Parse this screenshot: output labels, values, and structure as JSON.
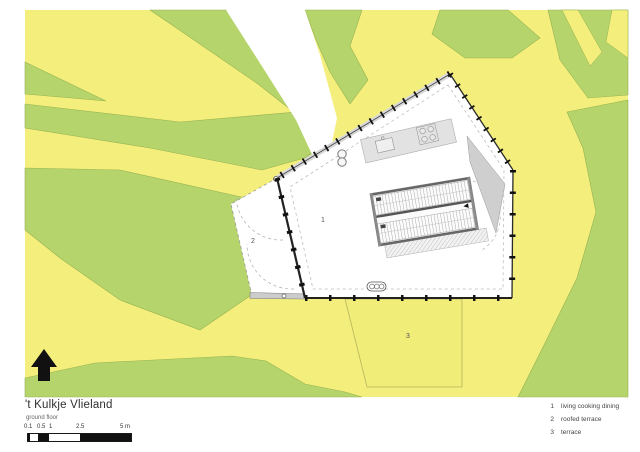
{
  "title": "'t Kulkje Vlieland",
  "subtitle": "ground floor",
  "scale_bar": {
    "labels": [
      "0.1",
      "0.5",
      "1",
      "2.5",
      "5 m"
    ],
    "unit": "m",
    "max": 5
  },
  "legend": {
    "items": [
      {
        "num": "1",
        "label": "living cooking dining"
      },
      {
        "num": "2",
        "label": "roofed terrace"
      },
      {
        "num": "3",
        "label": "terrace"
      }
    ]
  },
  "plan": {
    "room_labels": [
      "1",
      "2",
      "3"
    ],
    "rooms": [
      {
        "num": "1",
        "name": "living cooking dining"
      },
      {
        "num": "2",
        "name": "roofed terrace"
      },
      {
        "num": "3",
        "name": "terrace"
      }
    ]
  },
  "colors": {
    "sand": "#f4ef7c",
    "vegetation": "#b6d46c",
    "vegetation_edge": "#97b351",
    "path": "#ffffff",
    "plan_fill": "#ffffff",
    "plan_outline": "#2a2a2a",
    "gray_element": "#d9d9d9"
  }
}
